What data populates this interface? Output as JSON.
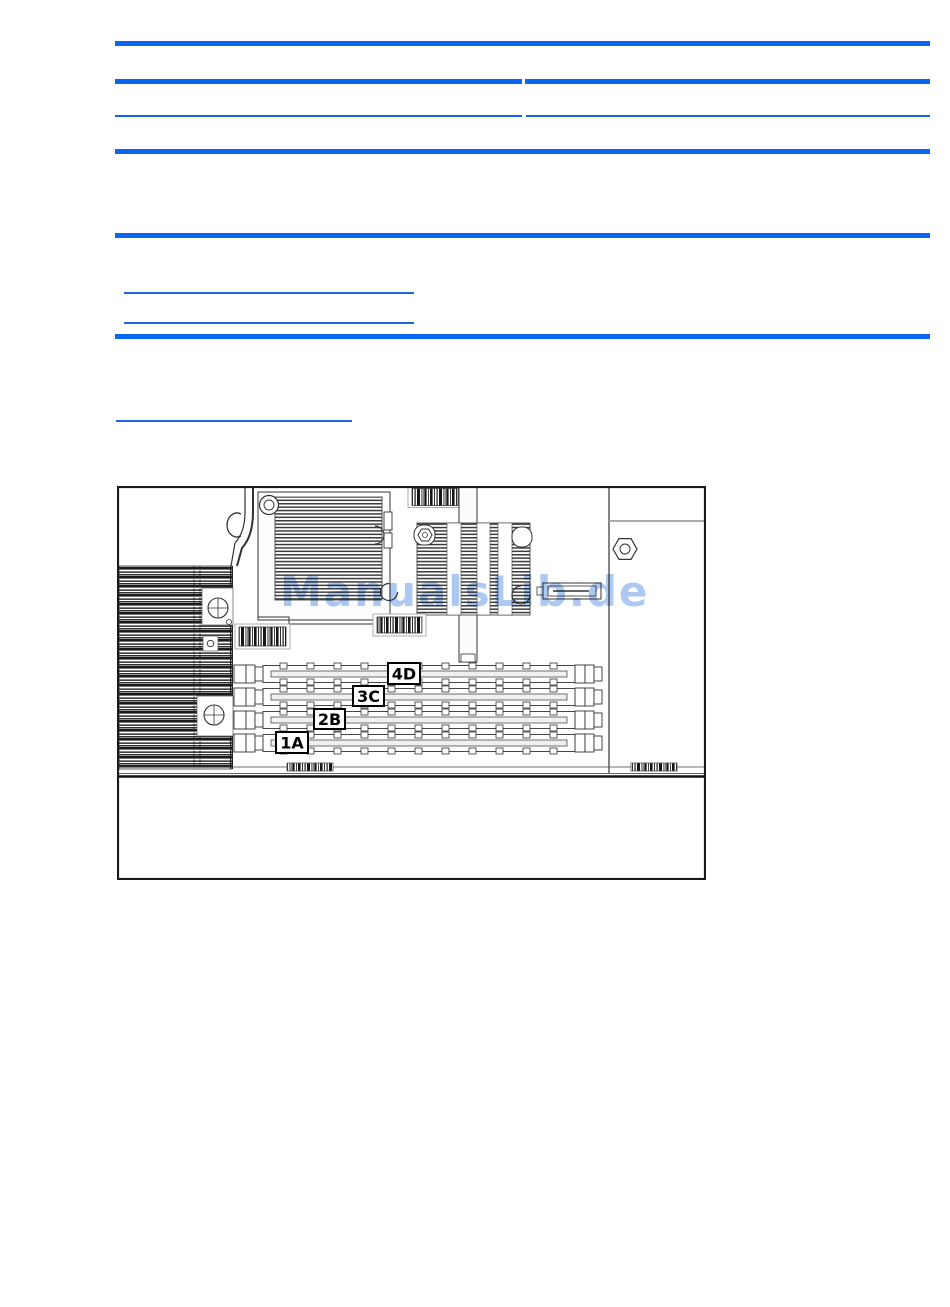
{
  "watermark": {
    "text": "ManualsLib.de",
    "color": "#adc9f1"
  },
  "figure": {
    "dimm_labels": [
      "4D",
      "3C",
      "2B",
      "1A"
    ]
  },
  "colors": {
    "rule_blue": "#0a66f2",
    "link_blue": "#1e66dd",
    "line_art": "#2a2a2a",
    "page_background": "#ffffff"
  }
}
